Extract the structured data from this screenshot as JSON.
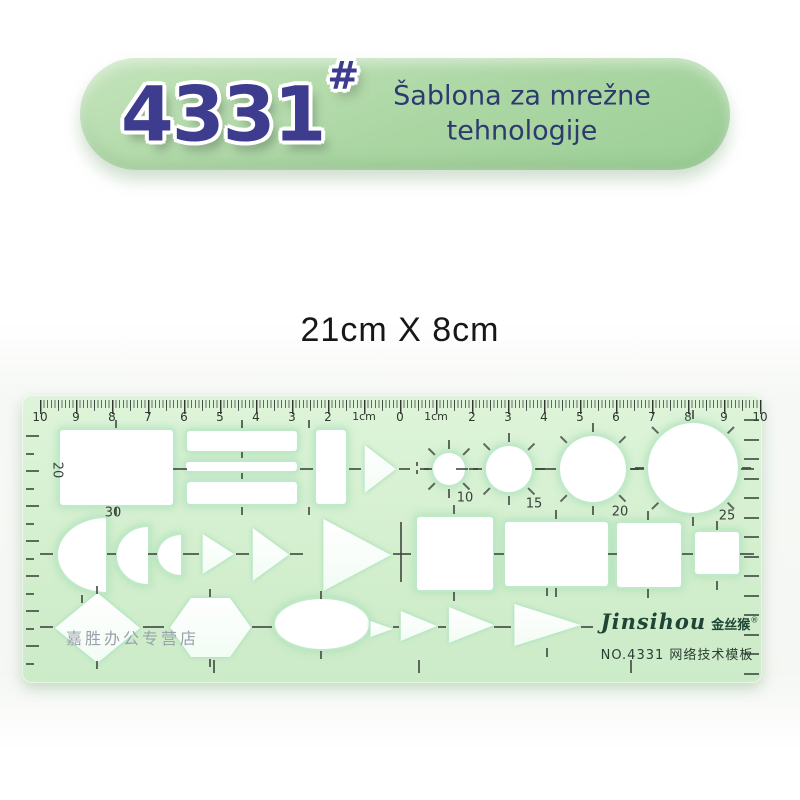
{
  "badge": {
    "model": "4331",
    "hash": "#",
    "title_line1": "Šablona za mrežne",
    "title_line2": "tehnologije",
    "bg_color": "#abd6a3",
    "number_color": "#3d3c8e",
    "title_color": "#2e3a6e"
  },
  "size_label": "21cm X 8cm",
  "template": {
    "body_color": "#d5efd0",
    "tick_color": "#3c423c",
    "brand_latin": "Jinsihou",
    "brand_cn": "金丝猴",
    "registered_mark": "®",
    "model_line": "NO.4331  网络技术模板",
    "watermark": "嘉胜办公专营店",
    "ruler_labels": [
      "10",
      "9",
      "8",
      "7",
      "6",
      "5",
      "4",
      "3",
      "2",
      "1cm",
      "0",
      "1cm",
      "2",
      "3",
      "4",
      "5",
      "6",
      "7",
      "8",
      "9",
      "10"
    ],
    "size_labels": [
      {
        "text": "20",
        "x": 35,
        "y": 75,
        "rot": 90
      },
      {
        "text": "30",
        "x": 91,
        "y": 118
      },
      {
        "text": "10",
        "x": 443,
        "y": 103
      },
      {
        "text": "15",
        "x": 512,
        "y": 109
      },
      {
        "text": "20",
        "x": 598,
        "y": 117
      },
      {
        "text": "25",
        "x": 705,
        "y": 121
      }
    ],
    "shapes": [
      {
        "name": "rect-large",
        "type": "rect",
        "x": 38,
        "y": 35,
        "w": 113,
        "h": 75
      },
      {
        "name": "bar-top",
        "type": "rect",
        "x": 165,
        "y": 36,
        "w": 110,
        "h": 20
      },
      {
        "name": "bar-middle",
        "type": "rect",
        "x": 164,
        "y": 67,
        "w": 111,
        "h": 9
      },
      {
        "name": "bar-bottom",
        "type": "rect",
        "x": 165,
        "y": 87,
        "w": 110,
        "h": 22
      },
      {
        "name": "rect-vertical",
        "type": "rect",
        "x": 294,
        "y": 35,
        "w": 30,
        "h": 74
      },
      {
        "name": "triangle-row1",
        "type": "tri-right",
        "x": 342,
        "y": 50,
        "w": 32,
        "h": 48
      },
      {
        "name": "circle-10mm",
        "type": "circle",
        "x": 411,
        "y": 58,
        "w": 32,
        "h": 32,
        "radial": true
      },
      {
        "name": "circle-15mm",
        "type": "circle",
        "x": 464,
        "y": 51,
        "w": 46,
        "h": 46,
        "radial": true
      },
      {
        "name": "circle-20mm",
        "type": "circle",
        "x": 538,
        "y": 41,
        "w": 66,
        "h": 66,
        "radial": true
      },
      {
        "name": "circle-25mm",
        "type": "circle",
        "x": 626,
        "y": 28,
        "w": 90,
        "h": 90,
        "radial": true
      },
      {
        "name": "semicircle-large",
        "type": "semicircle",
        "x": 36,
        "y": 123,
        "w": 48,
        "h": 74
      },
      {
        "name": "semicircle-medium",
        "type": "semicircle",
        "x": 95,
        "y": 132,
        "w": 31,
        "h": 57
      },
      {
        "name": "semicircle-small",
        "type": "semicircle",
        "x": 136,
        "y": 140,
        "w": 23,
        "h": 40
      },
      {
        "name": "triangle-small",
        "type": "tri-right",
        "x": 180,
        "y": 139,
        "w": 32,
        "h": 40
      },
      {
        "name": "triangle-medium",
        "type": "tri-right",
        "x": 230,
        "y": 133,
        "w": 37,
        "h": 53
      },
      {
        "name": "triangle-large",
        "type": "tri-right",
        "x": 300,
        "y": 124,
        "w": 69,
        "h": 72
      },
      {
        "name": "square-large",
        "type": "rect",
        "x": 395,
        "y": 122,
        "w": 76,
        "h": 73
      },
      {
        "name": "rect-wide",
        "type": "rect",
        "x": 483,
        "y": 127,
        "w": 103,
        "h": 64
      },
      {
        "name": "square-medium",
        "type": "rect",
        "x": 595,
        "y": 128,
        "w": 64,
        "h": 64
      },
      {
        "name": "square-small",
        "type": "rect",
        "x": 673,
        "y": 137,
        "w": 44,
        "h": 42
      },
      {
        "name": "diamond",
        "type": "diamond",
        "x": 33,
        "y": 198,
        "w": 85,
        "h": 70
      },
      {
        "name": "hexagon",
        "type": "hexagon",
        "x": 148,
        "y": 203,
        "w": 81,
        "h": 59
      },
      {
        "name": "ellipse",
        "type": "ellipse",
        "x": 253,
        "y": 204,
        "w": 94,
        "h": 50
      },
      {
        "name": "triangle-b1",
        "type": "tri-right",
        "x": 348,
        "y": 226,
        "w": 23,
        "h": 16
      },
      {
        "name": "triangle-b2",
        "type": "tri-right",
        "x": 378,
        "y": 216,
        "w": 37,
        "h": 30
      },
      {
        "name": "triangle-b3",
        "type": "tri-right",
        "x": 426,
        "y": 212,
        "w": 46,
        "h": 36
      },
      {
        "name": "triangle-b4",
        "type": "tri-right",
        "x": 491,
        "y": 209,
        "w": 68,
        "h": 42
      }
    ],
    "hmarks": [
      [
        151,
        74,
        14
      ],
      [
        278,
        74,
        13
      ],
      [
        327,
        74,
        12
      ],
      [
        377,
        74,
        11
      ],
      [
        402,
        74,
        8
      ],
      [
        434,
        74,
        12
      ],
      [
        513,
        74,
        12
      ],
      [
        609,
        74,
        13
      ],
      [
        719,
        74,
        13
      ],
      [
        18,
        159,
        13
      ],
      [
        85,
        159,
        9
      ],
      [
        126,
        159,
        9
      ],
      [
        161,
        159,
        16
      ],
      [
        214,
        159,
        13
      ],
      [
        268,
        159,
        13
      ],
      [
        371,
        159,
        18
      ],
      [
        472,
        159,
        10
      ],
      [
        586,
        159,
        9
      ],
      [
        660,
        159,
        11
      ],
      [
        718,
        159,
        14
      ],
      [
        18,
        232,
        13
      ],
      [
        121,
        232,
        21
      ],
      [
        230,
        232,
        20
      ],
      [
        371,
        232,
        6
      ],
      [
        416,
        232,
        8
      ],
      [
        472,
        232,
        17
      ],
      [
        559,
        232,
        12
      ]
    ],
    "vmarks": [
      [
        93,
        25,
        8
      ],
      [
        93,
        112,
        8
      ],
      [
        219,
        25,
        8
      ],
      [
        219,
        57,
        6
      ],
      [
        219,
        78,
        6
      ],
      [
        219,
        112,
        8
      ],
      [
        286,
        25,
        8
      ],
      [
        286,
        112,
        8
      ],
      [
        394,
        67,
        4
      ],
      [
        394,
        75,
        4
      ],
      [
        378,
        127,
        60
      ],
      [
        431,
        110,
        9
      ],
      [
        431,
        197,
        9
      ],
      [
        533,
        115,
        9
      ],
      [
        533,
        193,
        9
      ],
      [
        625,
        116,
        9
      ],
      [
        625,
        194,
        9
      ],
      [
        694,
        126,
        9
      ],
      [
        694,
        186,
        9
      ],
      [
        59,
        200,
        8
      ],
      [
        74,
        191,
        8
      ],
      [
        74,
        266,
        8
      ],
      [
        187,
        194,
        8
      ],
      [
        187,
        264,
        8
      ],
      [
        298,
        196,
        8
      ],
      [
        298,
        256,
        8
      ],
      [
        524,
        193,
        8
      ],
      [
        524,
        253,
        9
      ],
      [
        191,
        265,
        13
      ],
      [
        396,
        265,
        13
      ],
      [
        608,
        265,
        13
      ]
    ],
    "left_ticks": {
      "x": 4,
      "y_start": 40,
      "step": 17.5,
      "count": 14
    },
    "right_ticks": {
      "x": 722,
      "y_start": 24,
      "step": 19.5,
      "count": 14
    }
  }
}
